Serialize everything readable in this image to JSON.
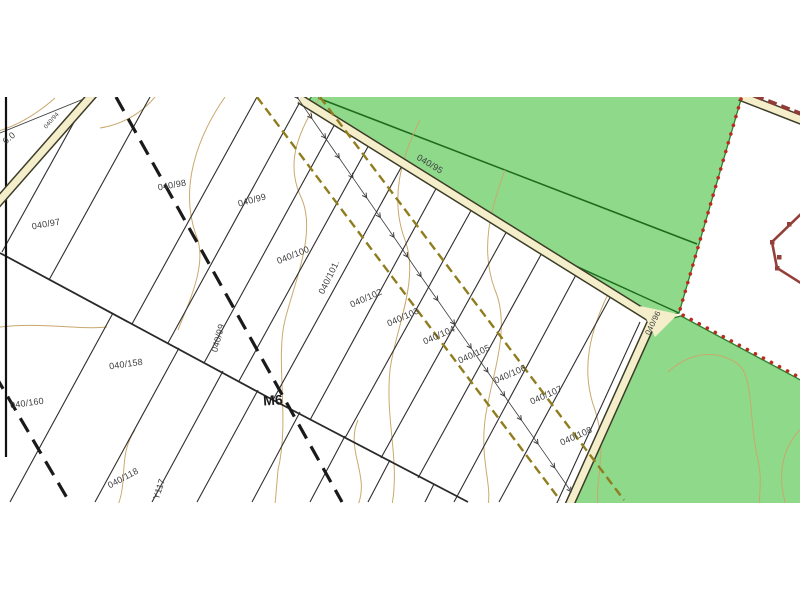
{
  "map": {
    "type": "cadastral-parcel-map",
    "labels": [
      {
        "text": "0.0",
        "x": 9,
        "y": 138,
        "rot": -40,
        "size": 9
      },
      {
        "text": "040/94",
        "x": 52,
        "y": 121,
        "rot": -48,
        "size": 6
      },
      {
        "text": "040/97",
        "x": 46,
        "y": 224,
        "rot": -10,
        "size": 9
      },
      {
        "text": "040/98",
        "x": 172,
        "y": 185,
        "rot": -10,
        "size": 9
      },
      {
        "text": "040/99",
        "x": 252,
        "y": 200,
        "rot": -15,
        "size": 9
      },
      {
        "text": "040/95",
        "x": 430,
        "y": 164,
        "rot": 31,
        "size": 9
      },
      {
        "text": "040/96",
        "x": 653,
        "y": 323,
        "rot": -64,
        "size": 8
      },
      {
        "text": "040/100",
        "x": 293,
        "y": 255,
        "rot": -22,
        "size": 9
      },
      {
        "text": "040/101.",
        "x": 329,
        "y": 277,
        "rot": -64,
        "size": 9
      },
      {
        "text": "040/102",
        "x": 366,
        "y": 298,
        "rot": -24,
        "size": 9
      },
      {
        "text": "040/103",
        "x": 403,
        "y": 317,
        "rot": -24,
        "size": 9
      },
      {
        "text": "040/104",
        "x": 439,
        "y": 335,
        "rot": -24,
        "size": 9
      },
      {
        "text": "040/105",
        "x": 474,
        "y": 354,
        "rot": -24,
        "size": 9
      },
      {
        "text": "040/106",
        "x": 510,
        "y": 374,
        "rot": -24,
        "size": 9
      },
      {
        "text": "040/107",
        "x": 546,
        "y": 395,
        "rot": -24,
        "size": 9
      },
      {
        "text": "040/108",
        "x": 576,
        "y": 436,
        "rot": -24,
        "size": 9
      },
      {
        "text": "040/99",
        "x": 218,
        "y": 338,
        "rot": -75,
        "size": 9
      },
      {
        "text": "040/158",
        "x": 126,
        "y": 364,
        "rot": -8,
        "size": 9
      },
      {
        "text": "040/160",
        "x": 27,
        "y": 403,
        "rot": -8,
        "size": 9
      },
      {
        "text": "040/118",
        "x": 123,
        "y": 478,
        "rot": -28,
        "size": 9
      },
      {
        "text": "Y117",
        "x": 159,
        "y": 489,
        "rot": -72,
        "size": 9
      },
      {
        "text": "M6",
        "x": 273,
        "y": 400,
        "rot": -4,
        "size": 14,
        "bold": true
      }
    ],
    "colors": {
      "vegetation_fill": "#8fd98b",
      "vegetation_border": "#2f7d2f",
      "road_fill": "#f4eecb",
      "road_edge": "#3c3c28",
      "contour": "#c9a96d",
      "parcel_line": "#2e2e2e",
      "admin_boundary_dots": "#b92d20",
      "building_outline": "#94403a",
      "track_dashed": "#8f7d1e",
      "path_dashed": "#1a1a1a"
    },
    "features": {
      "vegetation_parcels": [
        "040/95",
        "040/96 area"
      ],
      "road_labels": [
        "040/96"
      ],
      "boundary_label": "M6"
    }
  }
}
